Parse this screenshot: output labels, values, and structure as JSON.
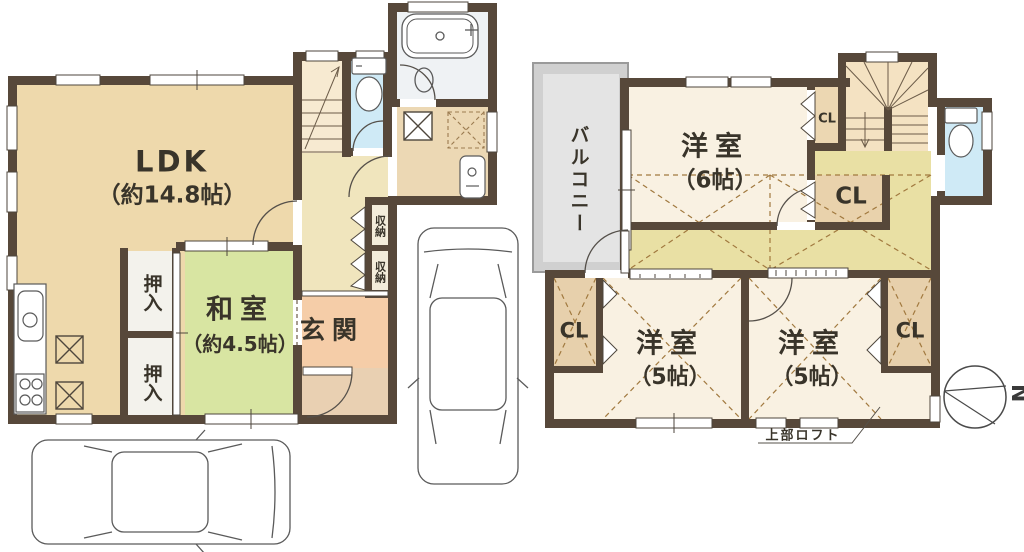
{
  "floor1": {
    "ldk": {
      "name": "LDK",
      "size": "（約14.8帖）"
    },
    "washitsu": {
      "name": "和室",
      "size": "（約4.5帖）"
    },
    "genkan": {
      "name": "玄関"
    },
    "oshiire_1": "押入",
    "oshiire_2": "押入",
    "shunou_1": "収納",
    "shunou_2": "収納"
  },
  "floor2": {
    "balcony": "バルコニー",
    "yoshitsu_6": {
      "name": "洋室",
      "size": "（6帖）"
    },
    "yoshitsu_5_left": {
      "name": "洋室",
      "size": "（5帖）"
    },
    "yoshitsu_5_right": {
      "name": "洋室",
      "size": "（5帖）"
    },
    "cl_upper_small": "CL",
    "cl_upper_large": "CL",
    "cl_lower_left": "CL",
    "cl_lower_right": "CL",
    "loft_note": "上部ロフト"
  },
  "compass": {
    "north": "N"
  },
  "colors": {
    "wall": "#57483a",
    "ldk": "#eed9ac",
    "washitsu": "#d8e5a2",
    "genkan": "#f5cda8",
    "doma": "#e9d0b2",
    "hall1": "#f0e5bd",
    "stairs1": "#f7ead1",
    "toilet": "#cfeaf6",
    "bathroom": "#eff2f4",
    "washroom": "#ecd8b4",
    "closet": "#ecd7b2",
    "room2f": "#f9f1e2",
    "hall2": "#e9e0a4",
    "stairs2": "#f4e2c2",
    "balcony": "#d6d6d6",
    "dash": "#a1793f"
  }
}
